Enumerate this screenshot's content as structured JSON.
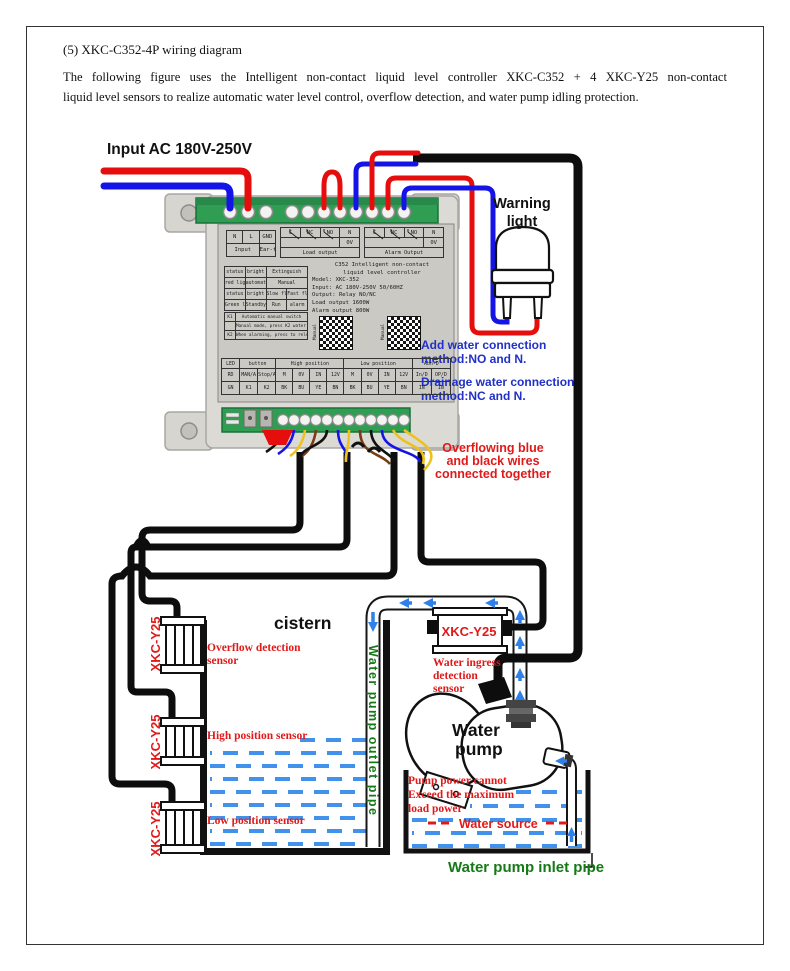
{
  "page": {
    "title": "(5) XKC-C352-4P wiring diagram",
    "para1": "The following figure uses the Intelligent non-contact liquid level controller XKC-C352  + 4 XKC-Y25 non-contact",
    "para2": "liquid level sensors to realize automatic water level control, overflow detection, and water pump idling protection."
  },
  "colors": {
    "wire_red": "#e60d0d",
    "wire_blue": "#1414e6",
    "wire_yellow": "#eec11c",
    "wire_brown": "#7a3c12",
    "cable_black": "#0d0d0d",
    "terminal_green": "#2f9e53",
    "water_blue": "#4292ec",
    "flow_arrow_blue": "#2f80e8",
    "annotation_red": "#e11919",
    "annotation_blue": "#2030c8",
    "annotation_green": "#157a15",
    "controller_body": "#dcdad5",
    "label_panel": "#cbc9c4"
  },
  "ann": {
    "input_ac": "Input AC 180V-250V",
    "warning_light": [
      "Warning",
      "light"
    ],
    "add_water": [
      "Add water connection",
      "method:NO and N."
    ],
    "drainage_water": [
      "Drainage water connection",
      "method:NC and N."
    ],
    "overflowing": [
      "Overflowing blue",
      "and black wires",
      "connected together"
    ],
    "cistern": "cistern",
    "outlet_pipe": "Water pump outlet pipe",
    "inlet_pipe": "Water pump inlet pipe",
    "water_pump": [
      "Water",
      "pump"
    ],
    "pump_power": [
      "Pump power cannot",
      "Exceed the maximum",
      "load power"
    ],
    "water_source": "Water source",
    "sensor_model": "XKC-Y25",
    "overflow_sensor": [
      "Overflow detection",
      "sensor"
    ],
    "high_sensor": "High position sensor",
    "low_sensor": "Low position sensor",
    "ingress_sensor": [
      "Water ingress",
      "detection",
      "sensor"
    ]
  },
  "ctl": {
    "input_table": {
      "c1": "N",
      "c2": "L",
      "c3": "GND",
      "r2c1": "Input",
      "r2c2": "Ear-th"
    },
    "load_table": {
      "h": [
        "C",
        "NC",
        "NO",
        "N"
      ],
      "ov": "0V",
      "caption": "Load output"
    },
    "alarm_table": {
      "h": [
        "C",
        "NC",
        "NO",
        "N"
      ],
      "ov": "0V",
      "caption": "Alarm Output"
    },
    "info_lines": [
      "C352 Intelligent non-contact",
      "liquid level controller",
      "Model: XKC-352",
      "Input: AC 180V-250V 50/60HZ",
      "Output: Relay NO/NC",
      "Load output 1600W",
      "Alarm output 800W"
    ],
    "led_rows": [
      [
        "status",
        "bright",
        "Extinguish",
        ""
      ],
      [
        "red light",
        "automatic",
        "Manual",
        ""
      ],
      [
        "status",
        "bright",
        "Slow flash",
        "Fast flash"
      ],
      [
        "Green light",
        "Standby",
        "Run",
        "alarm"
      ]
    ],
    "key_notes": [
      "K1",
      "Automatic manual switch",
      "Manual mode, press K2 water pump to start/stop",
      "K2",
      "When alarming, press to release the alarm"
    ],
    "qr_caption": "Manual",
    "map_groups": [
      "LED",
      "button",
      "High position",
      "Low position",
      "Abn-D"
    ],
    "map_row1": [
      "RD",
      "MAN/A",
      "Stop/A",
      "M",
      "0V",
      "IN",
      "12V",
      "M",
      "0V",
      "IN",
      "12V",
      "In/D",
      "OP/D"
    ],
    "map_row2": [
      "GN",
      "K1",
      "K2",
      "BK",
      "BU",
      "YE",
      "BN",
      "BK",
      "BU",
      "YE",
      "BN",
      "IN",
      "IN"
    ]
  }
}
